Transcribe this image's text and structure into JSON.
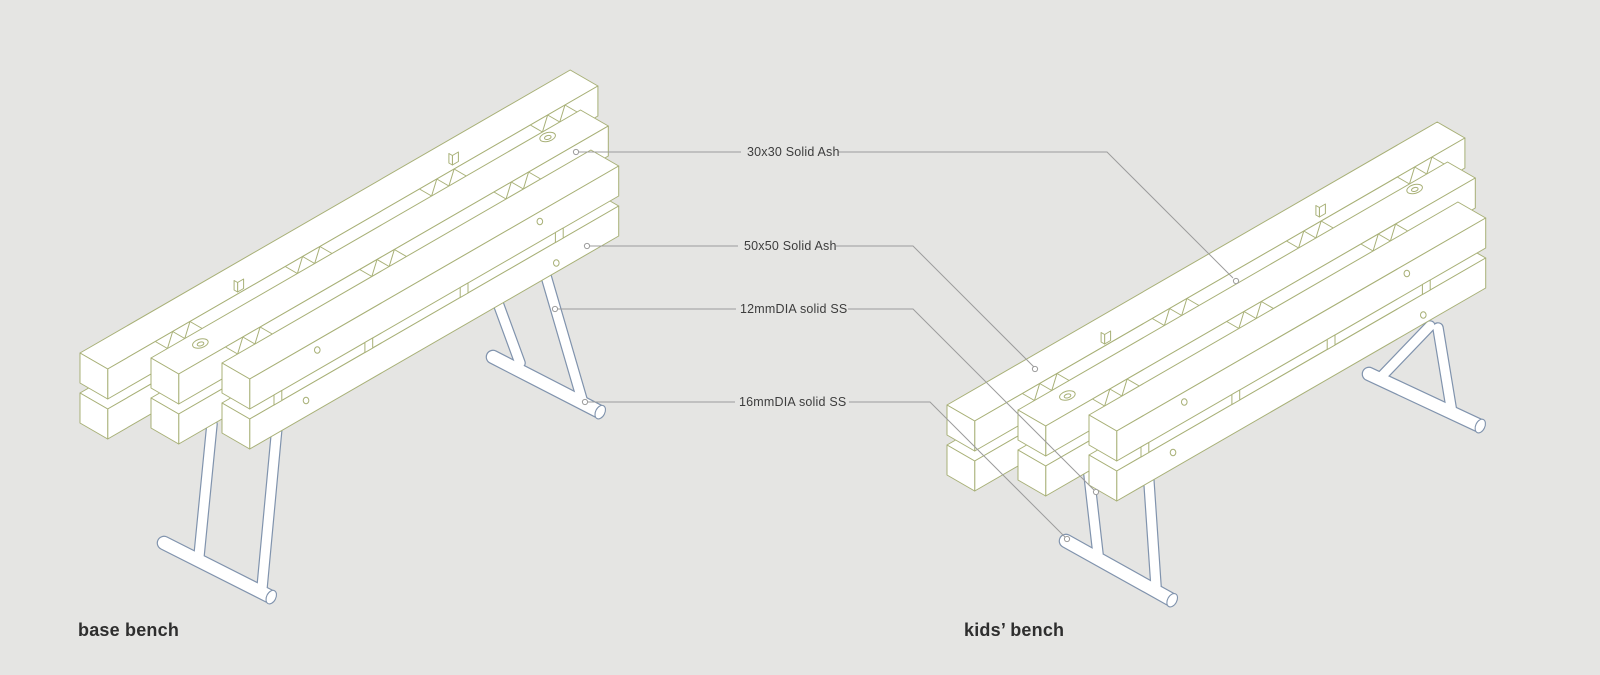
{
  "diagram_title": "bench construction diagram",
  "annotations": [
    {
      "text": "30x30 Solid Ash"
    },
    {
      "text": "50x50 Solid Ash"
    },
    {
      "text": "12mmDIA solid SS"
    },
    {
      "text": "16mmDIA solid SS"
    }
  ],
  "benches": [
    {
      "title": "base bench"
    },
    {
      "title": "kids’ bench"
    }
  ],
  "colors": {
    "background": "#e5e5e3",
    "wood_outline": "#a8b077",
    "steel_outline": "#8093ad",
    "leader_line": "#9c9c9c",
    "label_text": "#3d3d3d",
    "title_text": "#2e2e2e",
    "surface_fill": "#ffffff"
  }
}
